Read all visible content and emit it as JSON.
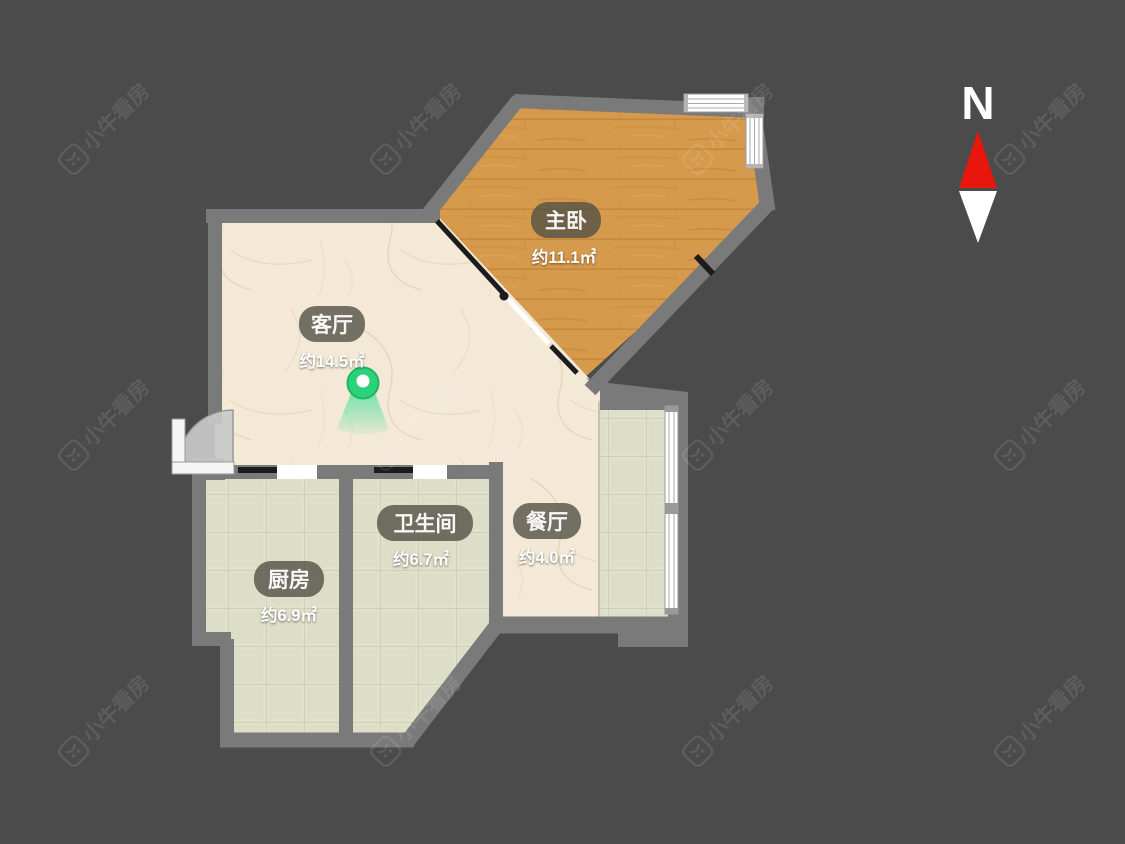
{
  "page": {
    "background_color": "#4b4b4b",
    "wall_color": "#7a7a7a"
  },
  "watermark": {
    "text": "小牛看房",
    "logo": "bull-logo"
  },
  "compass": {
    "label": "N",
    "north_color": "#e8160c",
    "south_color": "#ffffff"
  },
  "floor_plan": {
    "rooms": [
      {
        "id": "master-bedroom",
        "name": "主卧",
        "area": "约11.1㎡",
        "floor": "wood",
        "floor_color": "#d69a4d"
      },
      {
        "id": "living-room",
        "name": "客厅",
        "area": "约14.5㎡",
        "floor": "marble",
        "floor_color": "#f3e9d6"
      },
      {
        "id": "bathroom",
        "name": "卫生间",
        "area": "约6.7㎡",
        "floor": "tile",
        "floor_color": "#e0e1cb"
      },
      {
        "id": "dining-room",
        "name": "餐厅",
        "area": "约4.0㎡",
        "floor": "marble",
        "floor_color": "#f3e9d6"
      },
      {
        "id": "kitchen",
        "name": "厨房",
        "area": "约6.9㎡",
        "floor": "tile",
        "floor_color": "#e0e1cb"
      }
    ],
    "panorama_marker": {
      "room": "living-room",
      "color": "#2bd378"
    }
  }
}
